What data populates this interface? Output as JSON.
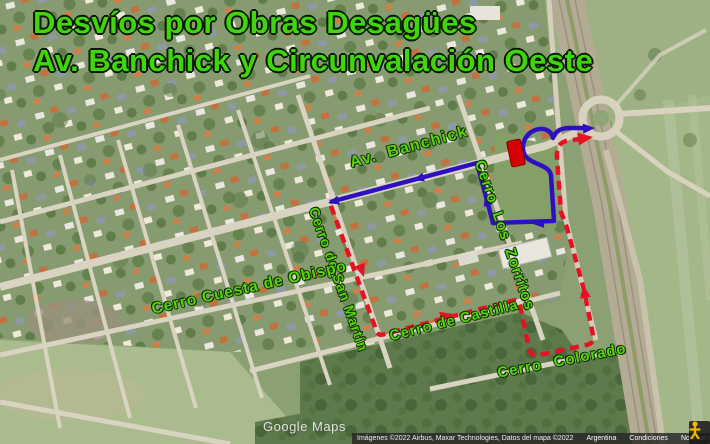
{
  "title": {
    "line1": "Desvíos por Obras Desagües",
    "line2": "Av. Banchick y Circunvalación Oeste"
  },
  "map": {
    "street_labels": {
      "banchick": "Av. Banchick",
      "zorritos": "Cerro Los Zorritos",
      "san_martin": "Cerro de San Martín",
      "obispo": "Cerro Cuesta de Obispo",
      "castilla": "Cerro de Castilla",
      "colorado": "Cerro Colorado"
    },
    "route_colors": {
      "blue_route": "#2e10c0",
      "red_route": "#e41323",
      "closure_marker": "#d60000",
      "label_green": "#56d40e",
      "title_green": "#41d50b"
    },
    "watermark": "Google Maps",
    "attribution": {
      "imagery": "Imágenes ©2022 Airbus, Maxar Technologies, Datos del mapa ©2022",
      "links": [
        "Argentina",
        "Condiciones",
        "Notificar un problema"
      ]
    }
  }
}
